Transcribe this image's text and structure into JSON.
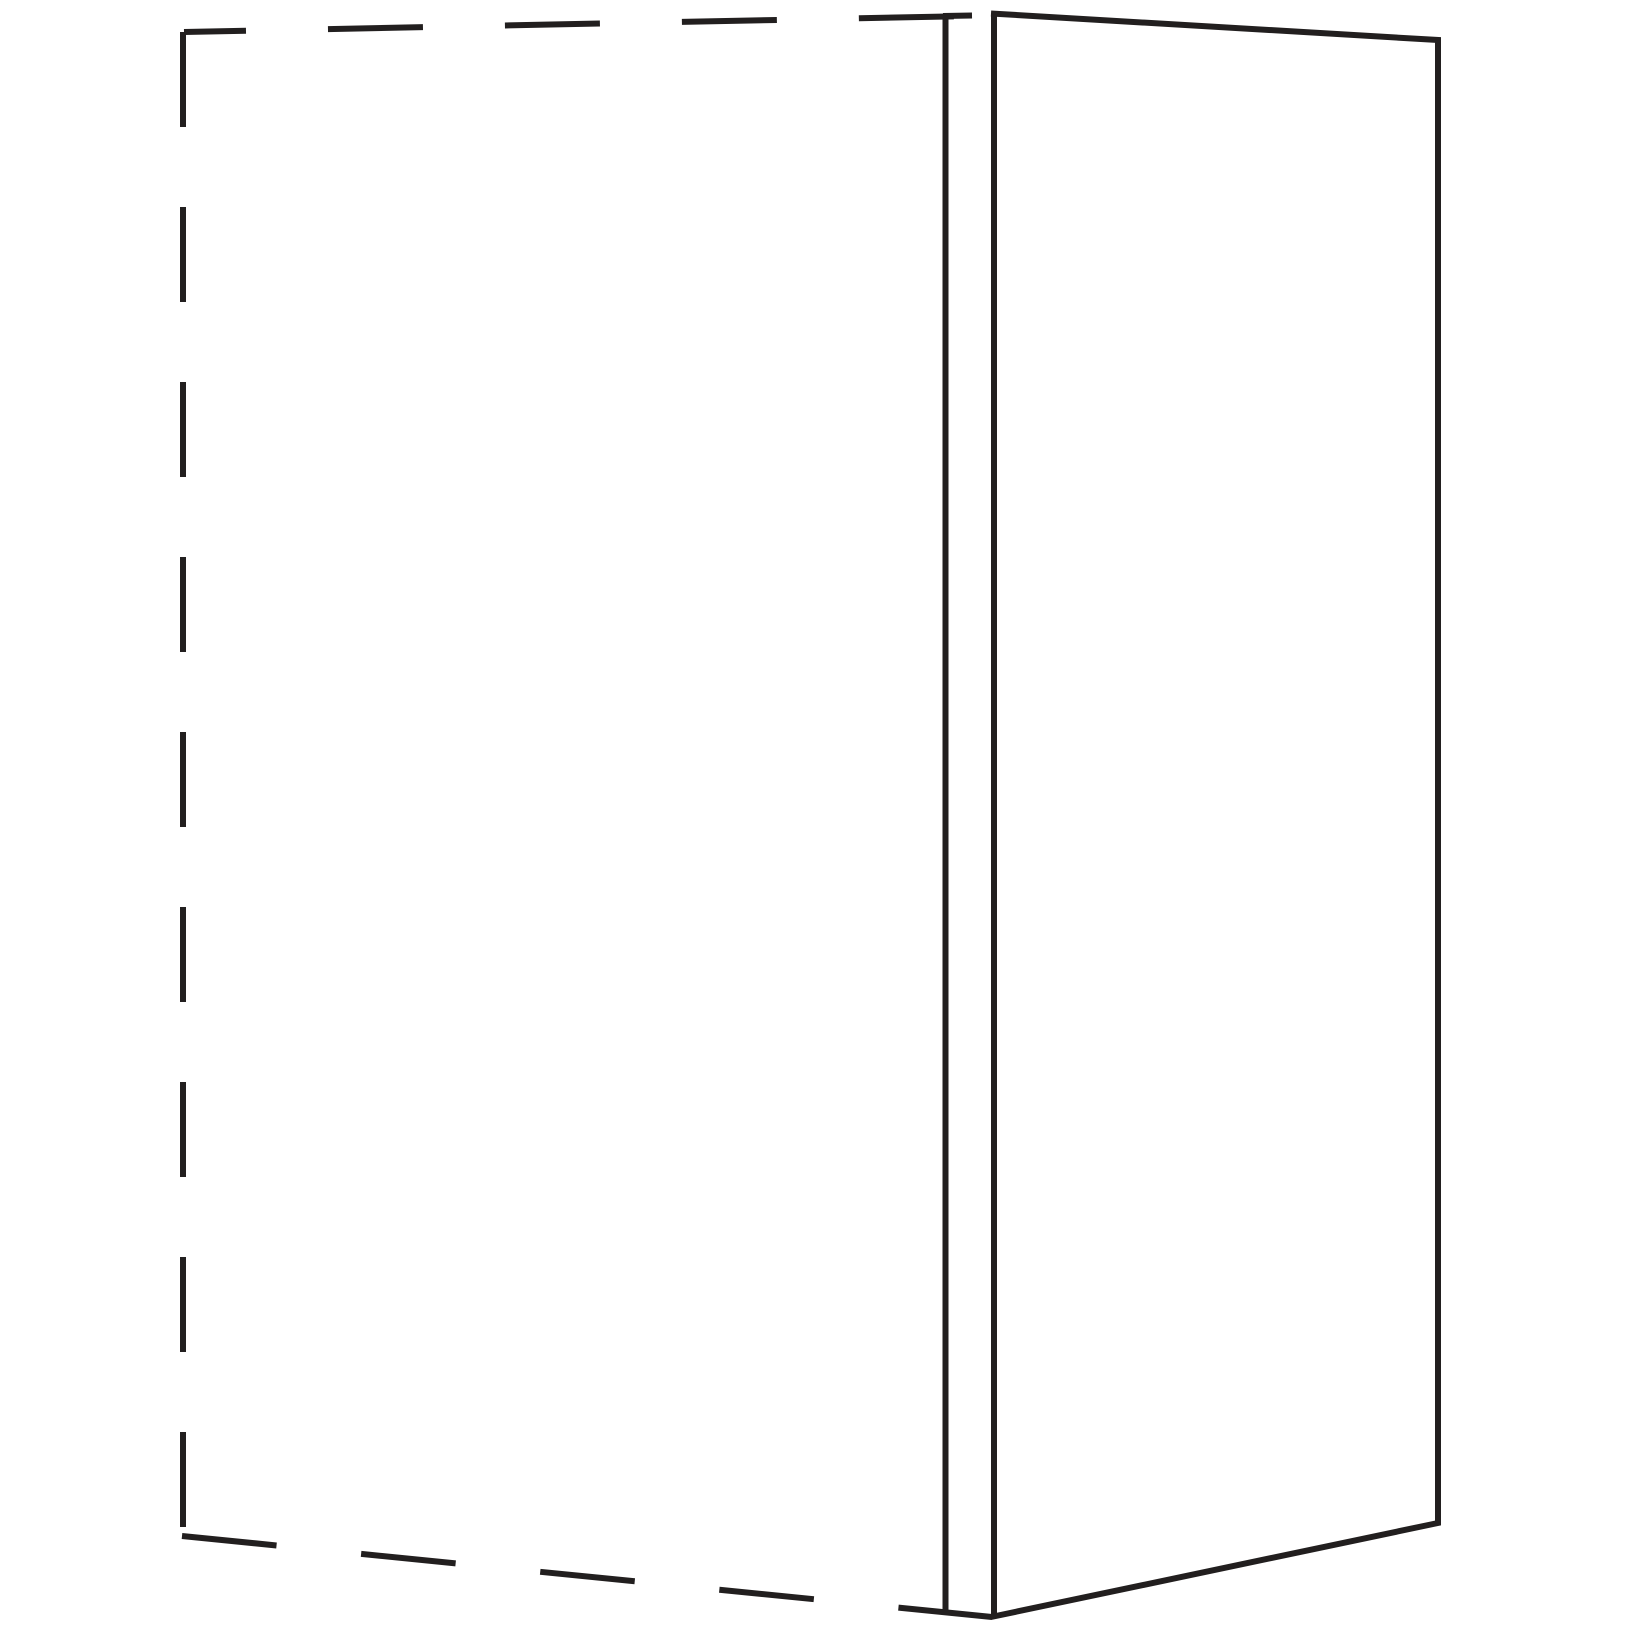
{
  "canvas": {
    "width": 1625,
    "height": 1625,
    "background": "#ffffff"
  },
  "diagram": {
    "kind": "furniture-side-panel-line-drawing",
    "stroke_color": "#221f1f",
    "stroke_width": 6,
    "cabinet_phantom_outline": {
      "style": "dashed",
      "segments": [
        {
          "name": "cabinet-outline-top-edge",
          "x1": 184,
          "y1": 32,
          "x2": 972,
          "y2": 16,
          "dash": "95 82",
          "offset": 33
        },
        {
          "name": "cabinet-outline-left-edge",
          "x1": 183,
          "y1": 32,
          "x2": 183,
          "y2": 1535,
          "dash": "95 80",
          "offset": 0
        },
        {
          "name": "cabinet-outline-bottom-edge",
          "x1": 182,
          "y1": 1536,
          "x2": 992,
          "y2": 1617,
          "dash": "95 85",
          "offset": 0
        }
      ]
    },
    "panel": {
      "style": "solid",
      "edge_face_segments": [
        {
          "name": "panel-edge-face-left-line",
          "x1": 945.5,
          "y1": 16,
          "x2": 945.5,
          "y2": 1612
        },
        {
          "name": "panel-edge-face-right-line",
          "x1": 994,
          "y1": 13,
          "x2": 994,
          "y2": 1617
        },
        {
          "name": "panel-edge-face-top-line",
          "x1": 943,
          "y1": 16,
          "x2": 972,
          "y2": 15.5
        }
      ],
      "front_face_path": [
        [
          991,
          13.5
        ],
        [
          1438,
          40
        ],
        [
          1438,
          1523
        ],
        [
          991,
          1617
        ]
      ]
    }
  }
}
